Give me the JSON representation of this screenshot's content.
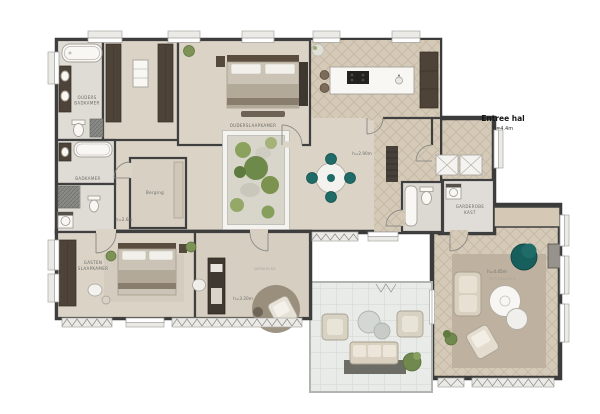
{
  "plan_title": "Floor plan",
  "colors": {
    "accent_teal": "#1d6a67",
    "wall": "#3b3b3b",
    "parquet": "#d5cab8",
    "plaster": "#dad3c6",
    "terrace_tile": "#e9ebe9"
  },
  "rooms": {
    "entree": {
      "label": "Entree hal",
      "height": "h=4.4m"
    },
    "dining": {
      "height": "h=2.90m"
    },
    "hall": {
      "height": "h=2.6m"
    },
    "office": {
      "label": "WERKPLEK",
      "height": "h=3.20m"
    },
    "living": {
      "label": "WOONKAMER",
      "height": "h=4.45m"
    },
    "master_bedroom": {
      "label": "OUDERSLAAPKAMER"
    },
    "master_bathroom": {
      "line1": "OUDERS",
      "line2": "BADKAMER"
    },
    "bathroom": {
      "label": "BADKAMER"
    },
    "storage": {
      "label": "Berging"
    },
    "guest_bedroom": {
      "line1": "GASTEN",
      "line2": "SLAAPKAMER"
    },
    "wardrobe": {
      "line1": "GARDEROBE",
      "line2": "KAST"
    }
  }
}
